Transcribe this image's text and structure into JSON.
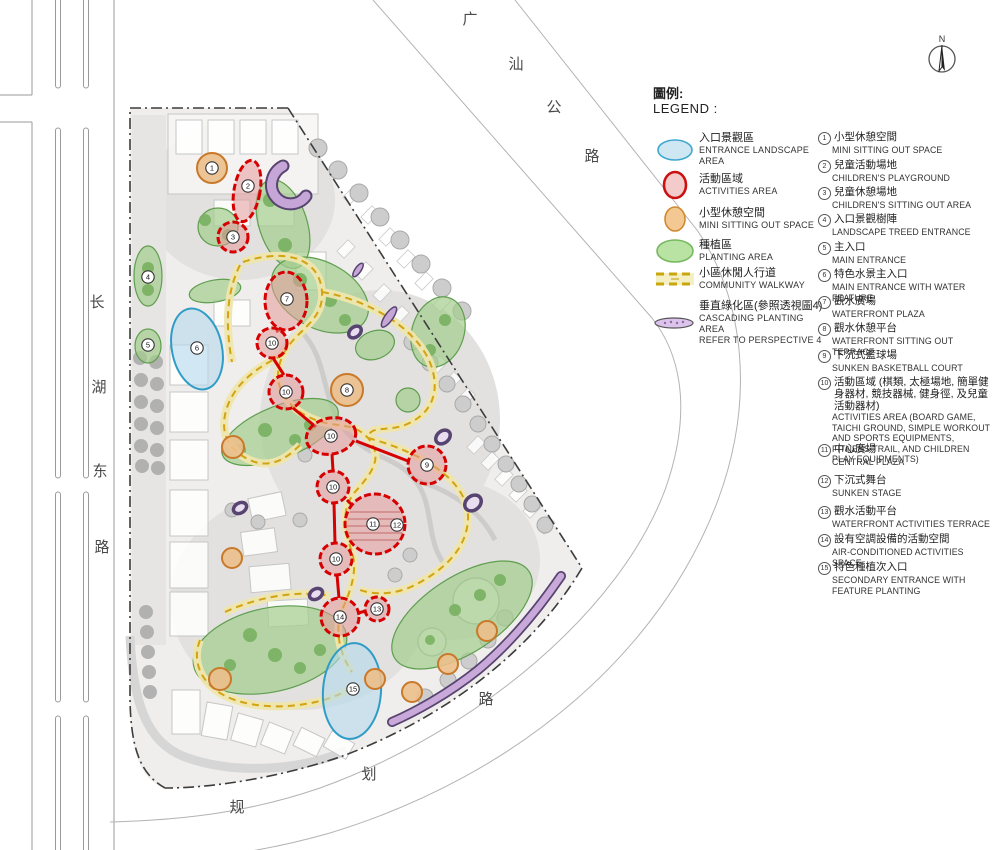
{
  "north_label": "N",
  "legend": {
    "title_zh": "圖例:",
    "title_en": "LEGEND :",
    "items": [
      {
        "zh": "入口景觀區",
        "en": "ENTRANCE LANDSCAPE AREA"
      },
      {
        "zh": "活動區域",
        "en": "ACTIVITIES AREA"
      },
      {
        "zh": "小型休憩空間",
        "en": "MINI SITTING OUT SPACE"
      },
      {
        "zh": "種植區",
        "en": "PLANTING AREA"
      },
      {
        "zh": "小區休閒人行道",
        "en": "COMMUNITY WALKWAY"
      },
      {
        "zh": "垂直綠化區(參照透視圖4)",
        "en": "CASCADING PLANTING AREA",
        "en2": "REFER TO PERSPECTIVE 4"
      }
    ]
  },
  "list": {
    "items": [
      {
        "num": "1",
        "zh": "小型休憩空間",
        "en": "MINI SITTING OUT SPACE"
      },
      {
        "num": "2",
        "zh": "兒童活動場地",
        "en": "CHILDREN'S PLAYGROUND"
      },
      {
        "num": "3",
        "zh": "兒童休憩場地",
        "en": "CHILDREN'S SITTING OUT AREA"
      },
      {
        "num": "4",
        "zh": "入口景觀樹陣",
        "en": "LANDSCAPE TREED ENTRANCE"
      },
      {
        "num": "5",
        "zh": "主入口",
        "en": "MAIN ENTRANCE"
      },
      {
        "num": "6",
        "zh": "特色水景主入口",
        "en": "MAIN ENTRANCE WITH WATER FEATURE"
      },
      {
        "num": "7",
        "zh": "觀水廣場",
        "en": "WATERFRONT PLAZA"
      },
      {
        "num": "8",
        "zh": "觀水休憩平台",
        "en": "WATERFRONT SITTING OUT TERRACE"
      },
      {
        "num": "9",
        "zh": "下沉式籃球場",
        "en": "SUNKEN BASKETBALL COURT"
      },
      {
        "num": "10",
        "zh": "活動區域 (棋類, 太極場地, 簡單健身器材, 競技器械, 健身徑, 及兒童活動器材)",
        "en": "ACTIVITIES AREA (BOARD GAME, TAICHI GROUND, SIMPLE WORKOUT AND SPORTS EQUIPMENTS, FITNESS TRAIL, AND CHILDREN PLAY EQUIPMENTS)"
      },
      {
        "num": "11",
        "zh": "中心廣場",
        "en": "CENTRAL PLAZA"
      },
      {
        "num": "12",
        "zh": "下沉式舞台",
        "en": "SUNKEN STAGE"
      },
      {
        "num": "13",
        "zh": "觀水活動平台",
        "en": "WATERFRONT ACTIVITIES TERRACE"
      },
      {
        "num": "14",
        "zh": "設有空調設備的活動空間",
        "en": "AIR-CONDITIONED ACTIVITIES SPACE"
      },
      {
        "num": "15",
        "zh": "特色種植次入口",
        "en": "SECONDARY ENTRANCE WITH FEATURE PLANTING"
      }
    ]
  },
  "roads": {
    "guangshan": [
      "广",
      "汕",
      "公",
      "路"
    ],
    "changhu": [
      "长",
      "湖",
      "东",
      "路"
    ],
    "guihua": [
      "规",
      "划",
      "路"
    ]
  },
  "map": {
    "markers": [
      "1",
      "2",
      "3",
      "4",
      "5",
      "6",
      "7",
      "8",
      "9",
      "10",
      "10",
      "10",
      "10",
      "10",
      "11",
      "12",
      "13",
      "14",
      "15"
    ]
  },
  "colors": {
    "entrance_blue": "#2f9cc7",
    "activity_red": "#d60000",
    "sitting_orange": "#c9792a",
    "planting_green": "#5f9e4f",
    "walkway_yellow": "#d2a315",
    "cascading_purple": "#8a6aa0",
    "boundary_dark": "#3c3c3c"
  }
}
